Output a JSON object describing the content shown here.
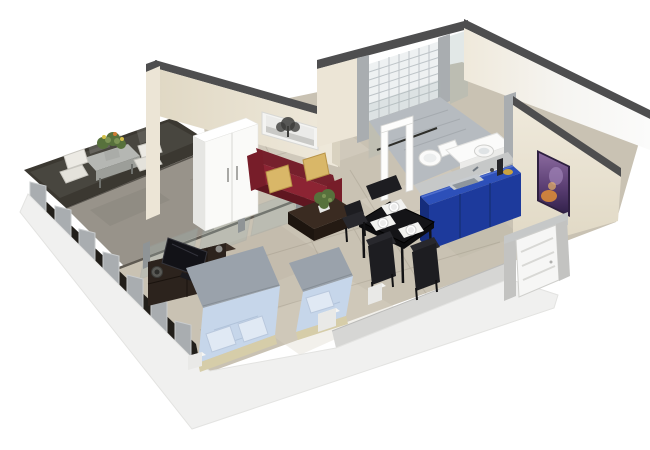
{
  "meta": {
    "title": "3D isometric cutaway floor plan rendering of a studio apartment",
    "view": "bird's-eye axonometric render, white background"
  },
  "scene": {
    "rooms": [
      "balcony",
      "living-sleeping-area",
      "kitchen",
      "bathroom",
      "entrance"
    ],
    "objects": [
      "balcony-table",
      "balcony-chairs",
      "glass-partition",
      "wardrobe",
      "tree-picture",
      "red-sofa",
      "gold-pillows",
      "coffee-table",
      "potted-plant",
      "dining-table",
      "dining-chairs",
      "place-settings",
      "blue-kitchen-counter",
      "kitchen-sink",
      "tiled-shower",
      "toilet",
      "vanity-basin",
      "purple-artwork",
      "entry-door",
      "tv-cabinet",
      "flat-tv",
      "double-bed",
      "single-bed",
      "nightstands",
      "window-wall-pillars"
    ]
  },
  "colors": {
    "bg": "#ffffff",
    "wall_top": "#4e4e4f",
    "cream": "#efe9db",
    "cream_dark": "#e0d8c4",
    "cream_mid": "#ece5d6",
    "cream_edge": "#d9d2c0",
    "white_soft": "#f6f5f2",
    "slab_white": "#f0f0ef",
    "slab_gray_face": "#d6d6d4",
    "pillar_gray": "#a9adb0",
    "pillar_light": "#c6c8c8",
    "window_dark": "#221f1a",
    "balcony_glass": "#3b3831",
    "balcony_floor": "#98938a",
    "floor_main": "#c9c2b3",
    "floor_light": "#d9d3c6",
    "floor_dark": "#b2aa99",
    "glass_tint": "#9fb2b0",
    "track_dark": "#45413a",
    "post_gray": "#8f9496",
    "concrete": "#b5b7b3",
    "concrete_dark": "#9c9e99",
    "plant_green": "#57713c",
    "plant_light": "#7c9355",
    "chair_white": "#eceae4",
    "chair_white2": "#e4e2db",
    "sofa_back": "#76202c",
    "sofa_main": "#8c2433",
    "sofa_front": "#5f1620",
    "sofa_arm": "#771d29",
    "pillow_gold": "#d9b768",
    "pillow_edge": "#b99448",
    "wood_dark": "#3a2b21",
    "wood_darker": "#241a13",
    "wood_face2": "#1d150f",
    "tv_black": "#121217",
    "cab_front": "#2c231d",
    "cab_top": "#3e3128",
    "cab_seam": "#1a130e",
    "table_black": "#141417",
    "table_edge": "#0c0c0e",
    "chair_black": "#1d1d21",
    "chair_black2": "#28282d",
    "mat_white": "#f2f2f0",
    "bed_gray": "#9aa2ab",
    "bed_blue": "#c6d6ea",
    "bed_blue_light": "#e0e9f4",
    "bed_base": "#d6cda9",
    "tile_white": "#eef1f2",
    "grout": "#b6bdc1",
    "bath_floor": "#b6bbc0",
    "fixture": "#fbfbfa",
    "fixture_side": "#ebebe9",
    "basin_inner": "#dfe3e5",
    "counter_top": "#2d50b9",
    "counter_front": "#1d3a9c",
    "counter_side": "#152d7c",
    "counter_hl": "#5b79d4",
    "sink_light": "#c8ccd0",
    "sink_gray": "#8e969d",
    "door_white": "#f6f6f5",
    "jamb": "#c3c3c1",
    "art_dark": "#2e2040",
    "art_p1": "#8a6a9e",
    "art_p3": "#31214a",
    "art_orange": "#d98a3a",
    "art_lav": "#a98cc0",
    "art_glow": "#e8b367",
    "tree_frame": "#f4f4f2",
    "tree_inner": "#ebebe9",
    "tree_ground": "#c9c9c6",
    "tree_dark": "#3d3d3b",
    "nstand": "#e9e9e7",
    "nstand_top": "#f6f6f4",
    "white_frame": "#fdfdfc"
  }
}
